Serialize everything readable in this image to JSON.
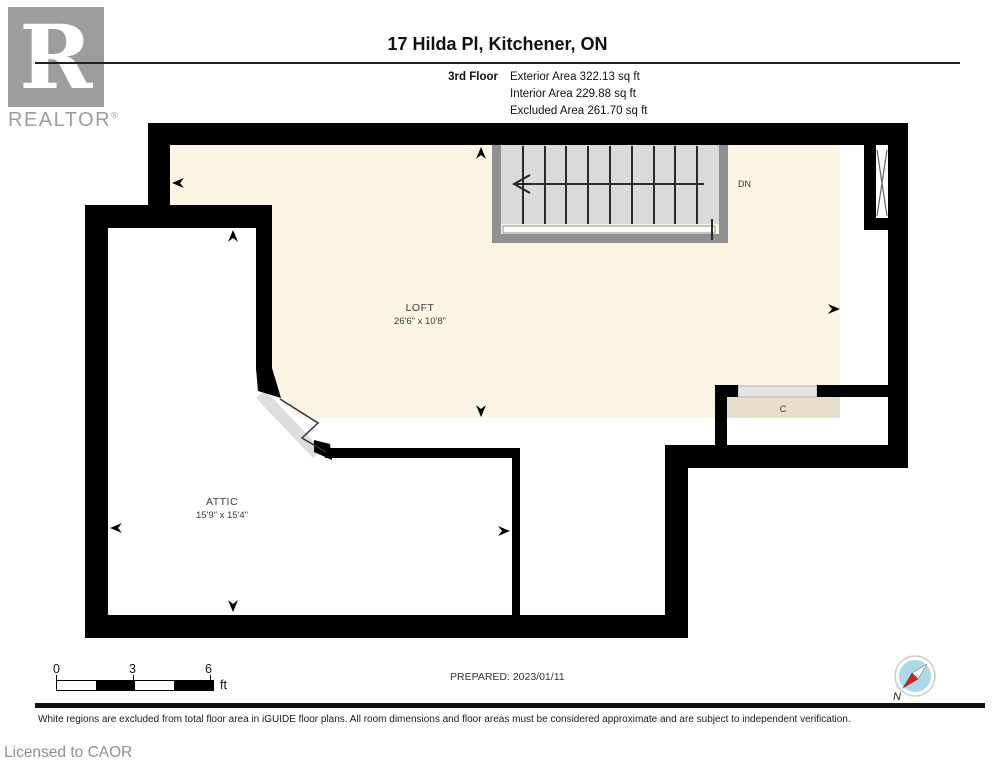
{
  "header": {
    "logo": {
      "letter": "R",
      "text": "REALTOR",
      "reg": "®"
    },
    "title": "17 Hilda Pl, Kitchener, ON",
    "floor_label": "3rd Floor",
    "areas": [
      "Exterior Area 322.13 sq ft",
      "Interior Area 229.88 sq ft",
      "Excluded Area 261.70 sq ft"
    ]
  },
  "plan": {
    "rooms": [
      {
        "name": "LOFT",
        "dims": "26'6\" x 10'8\""
      },
      {
        "name": "ATTIC",
        "dims": "15'9\" x 15'4\""
      }
    ],
    "closet_label": "C",
    "stairs_label": "DN",
    "colors": {
      "interior_area": "#fdf5e3",
      "excluded_area": "#ffffff",
      "closet_fill": "#e8deca",
      "wall": "#000000",
      "stair_fill": "#dadada",
      "stair_frame": "#8f8f8f",
      "compass_blue": "#abd9ea",
      "compass_red": "#c8242c"
    }
  },
  "footer": {
    "scale": {
      "ticks": [
        "0",
        "3",
        "6"
      ],
      "unit": "ft"
    },
    "prepared": "PREPARED: 2023/01/11",
    "compass_label": "N",
    "disclaimer": "White regions are excluded from total floor area in iGUIDE floor plans. All room dimensions and floor areas must be considered approximate and are subject to independent verification.",
    "license": "Licensed to CAOR"
  }
}
